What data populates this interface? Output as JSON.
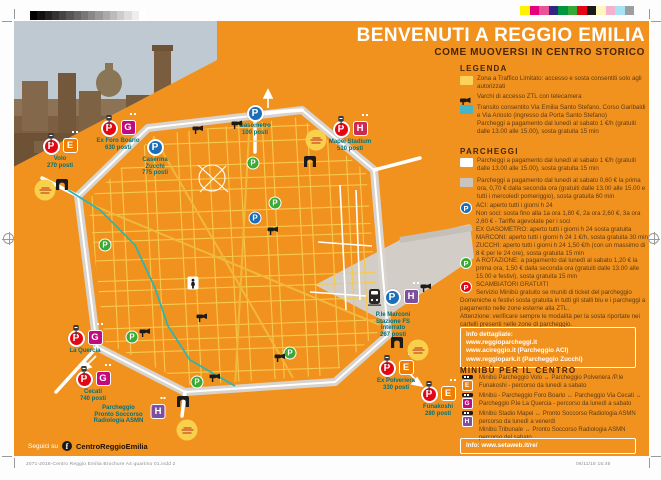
{
  "header": {
    "title": "BENVENUTI A REGGIO EMILIA",
    "subtitle": "COME MUOVERSI IN CENTRO STORICO"
  },
  "colors": {
    "orange": "#F2921E",
    "red": "#E30613",
    "blue": "#1C6FB6",
    "green": "#3AAA35",
    "ztl_yellow": "#FBD35B",
    "transit_blue": "#45B5C8",
    "swatch_white": "#FFFFFF",
    "swatch_gray": "#C9C4BE",
    "badge_e": "#EF7D00",
    "badge_g": "#C00A7E",
    "badge_h_purple": "#7D4F9D",
    "badge_h_crimson": "#C92B55",
    "label_teal": "#00727B"
  },
  "legend": {
    "heading": "LEGENDA",
    "items": [
      {
        "icon": "ztl-swatch",
        "text": "Zona a Traffico Limitato: accesso e sosta consentiti solo agli autorizzati"
      },
      {
        "icon": "camera-icon",
        "text": "Varchi di accesso ZTL con telecamera"
      },
      {
        "icon": "transit-swatch",
        "text": "Transito consentito Via Emilia Santo Stefano, Corso Garibaldi e Via Ariosto (ingresso da Porta Santo Stefano)\nParcheggi a pagamento dal lunedì al sabato 1 €/h (gratuiti dalle 13.00 alle 15.00), sosta gratuita 15 min"
      }
    ]
  },
  "parcheggi": {
    "heading": "PARCHEGGI",
    "items": [
      {
        "icon": "white-swatch",
        "text": "Parcheggi a pagamento dal lunedì al sabato 1 €/h (gratuiti dalle 13.00 alle 15.00), sosta gratuita 15 min"
      },
      {
        "icon": "gray-swatch",
        "text": "Parcheggi a pagamento dal lunedì al sabato 0,60 € la prima ora, 0,70 € dalla seconda ora (gratuiti dalle 13.00 alle 15.00 e tutti i mercoledì pomeriggio), sosta gratuita 60 min"
      },
      {
        "icon": "p-blue",
        "text": "ACI: aperto tutti i giorni h 24\nNon soci: sosta fino alla 1a ora 1,80 €, 2a ora 2,60 €, 3a ora 2,60 € - Tariffe agevolate per i soci\nEX GASOMETRO: aperto tutti i giorni h 24 sosta gratuita\nMARCONI: aperto tutti i giorni h 24 1 €/h, sosta gratuita 30 min\nZUCCHI: aperto tutti i giorni h 24 1,50 €/h (con un massimo di 8 € per le 24 ore), sosta gratuita 15 min"
      },
      {
        "icon": "p-green",
        "text": "A ROTAZIONE: a pagamento dal lunedì al sabato 1,20 € la prima ora, 1,50 € dalla seconda ora (gratuiti dalle 13.00 alle 15.00 e festivi), sosta gratuita 15 min"
      },
      {
        "icon": "p-red",
        "text": "SCAMBIATORI GRATUITI\nServizio Minibù gratuito se muniti di ticket del parcheggio"
      }
    ],
    "note": "Domeniche e festivi sosta gratuita in tutti gli stalli blu e i parcheggi a pagamento nelle zone esterne alla ZTL.\nAttenzione: verificare sempre le modalità per la sosta riportate nei cartelli presenti nelle zone di parcheggio.",
    "info_box": "Info dettagliate:\nwww.reggioparcheggi.it\nwww.acireggio.it (Parcheggio ACI)\nwww.reggiopark.it (Parcheggio Zucchi)"
  },
  "minibu": {
    "heading": "MINIBÙ PER IL CENTRO",
    "items": [
      {
        "letter": "E",
        "color": "#EF7D00",
        "text": "Minibù Parcheggio Volo ↔ Parcheggio Polveriera /P.le Funakoshi - percorso da lunedì a sabato"
      },
      {
        "letter": "G",
        "color": "#C00A7E",
        "text": "Minibù - Parcheggio Foro Boario ↔ Parcheggio Via Cecati ↔ Parcheggio P.le La Quercia - percorso da lunedì a sabato"
      },
      {
        "letter": "H",
        "color": "#7D4F9D",
        "text": "Minibù Stadio Mapei ↔ Pronto Soccorso Radiologia ASMN percorso da lunedì a venerdì"
      },
      {
        "letter": "",
        "color": "",
        "text": "Minibù Tribunale ↔ Pronto Soccorso Radiologia ASMN percorso del sabato"
      }
    ],
    "info_box": "Info: www.setaweb.it/re/"
  },
  "map": {
    "markers": [
      {
        "id": "volo",
        "cx": 60,
        "top": 138,
        "badges": [
          {
            "k": "P",
            "c": "#E30613",
            "ex": "meter"
          },
          {
            "k": "E",
            "c": "#EF7D00",
            "ex": "bus"
          }
        ],
        "label": "Volo\n270 posti"
      },
      {
        "id": "ex-foro-boario",
        "cx": 118,
        "top": 120,
        "badges": [
          {
            "k": "P",
            "c": "#E30613",
            "ex": "meter"
          },
          {
            "k": "G",
            "c": "#C00A7E",
            "ex": "bus"
          }
        ],
        "label": "Ex Foro Boario\n630 posti"
      },
      {
        "id": "caserma-zucchi",
        "cx": 155,
        "top": 139,
        "badges": [
          {
            "k": "P",
            "c": "#1C6FB6"
          }
        ],
        "label": "Caserma\nZucchi\n775 posti"
      },
      {
        "id": "gasometro",
        "cx": 255,
        "top": 105,
        "badges": [
          {
            "k": "P",
            "c": "#1C6FB6"
          }
        ],
        "label": "Gasometro\n100 posti"
      },
      {
        "id": "mapei-stadium",
        "cx": 350,
        "top": 121,
        "badges": [
          {
            "k": "P",
            "c": "#E30613",
            "ex": "meter"
          },
          {
            "k": "H",
            "c": "#C92B55",
            "ex": "bus"
          }
        ],
        "label": "Mapei Stadium\n510 posti"
      },
      {
        "id": "ple-marconi-stazione",
        "cx": 393,
        "top": 289,
        "badges": [
          {
            "k": "train"
          },
          {
            "k": "P",
            "c": "#1C6FB6"
          },
          {
            "k": "H",
            "c": "#7D4F9D",
            "ex": "bus"
          }
        ],
        "label": "P.le Marconi\nStazione FS\ninterrato\n267 posti"
      },
      {
        "id": "ex-polveriera",
        "cx": 396,
        "top": 360,
        "badges": [
          {
            "k": "P",
            "c": "#E30613",
            "ex": "meter"
          },
          {
            "k": "E",
            "c": "#EF7D00",
            "ex": "bus"
          }
        ],
        "label": "Ex Polveriera\n330 posti"
      },
      {
        "id": "funakoshi",
        "cx": 438,
        "top": 386,
        "badges": [
          {
            "k": "P",
            "c": "#E30613",
            "ex": "meter"
          },
          {
            "k": "E",
            "c": "#EF7D00",
            "ex": "bus"
          }
        ],
        "label": "Funakoshi\n280 posti"
      },
      {
        "id": "la-quercia",
        "cx": 85,
        "top": 330,
        "badges": [
          {
            "k": "P",
            "c": "#E30613",
            "ex": "meter"
          },
          {
            "k": "G",
            "c": "#C00A7E",
            "ex": "bus"
          }
        ],
        "label": "La Quercia"
      },
      {
        "id": "cecati",
        "cx": 93,
        "top": 371,
        "badges": [
          {
            "k": "P",
            "c": "#E30613",
            "ex": "meter"
          },
          {
            "k": "G",
            "c": "#C00A7E",
            "ex": "bus"
          }
        ],
        "label": "Cecati\n740 posti"
      },
      {
        "id": "pronto-soccorso-asmn",
        "cx": 158,
        "top": 404,
        "badges": [
          {
            "k": "H",
            "c": "#7D4F9D",
            "ex": "bus"
          }
        ],
        "label": "",
        "sidelabel": "Parcheggio\nPronto Soccorso\nRadiologia ASMN"
      }
    ],
    "green_p": [
      [
        253,
        163
      ],
      [
        275,
        203
      ],
      [
        105,
        245
      ],
      [
        132,
        337
      ],
      [
        197,
        382
      ],
      [
        290,
        353
      ]
    ],
    "blue_p_small": [
      [
        255,
        218
      ]
    ],
    "cameras": [
      [
        198,
        130
      ],
      [
        237,
        125
      ],
      [
        273,
        231
      ],
      [
        202,
        318
      ],
      [
        145,
        333
      ],
      [
        215,
        378
      ],
      [
        280,
        358
      ],
      [
        426,
        288
      ]
    ],
    "gates": [
      [
        62,
        186
      ],
      [
        310,
        163
      ],
      [
        397,
        344
      ],
      [
        183,
        403
      ]
    ],
    "stickers": [
      [
        45,
        190
      ],
      [
        316,
        140
      ],
      [
        418,
        350
      ],
      [
        187,
        430
      ]
    ],
    "statue": [
      193,
      283
    ]
  },
  "footer": {
    "follow": "Seguici su",
    "fb_letter": "f",
    "fb_name": "CentroReggioEmilia"
  },
  "print": {
    "filename": "2071-2018-Centro Reggio Emilia Brochure A4 quartino 01.indd   2",
    "timestamp": "06/11/18   15:46"
  }
}
